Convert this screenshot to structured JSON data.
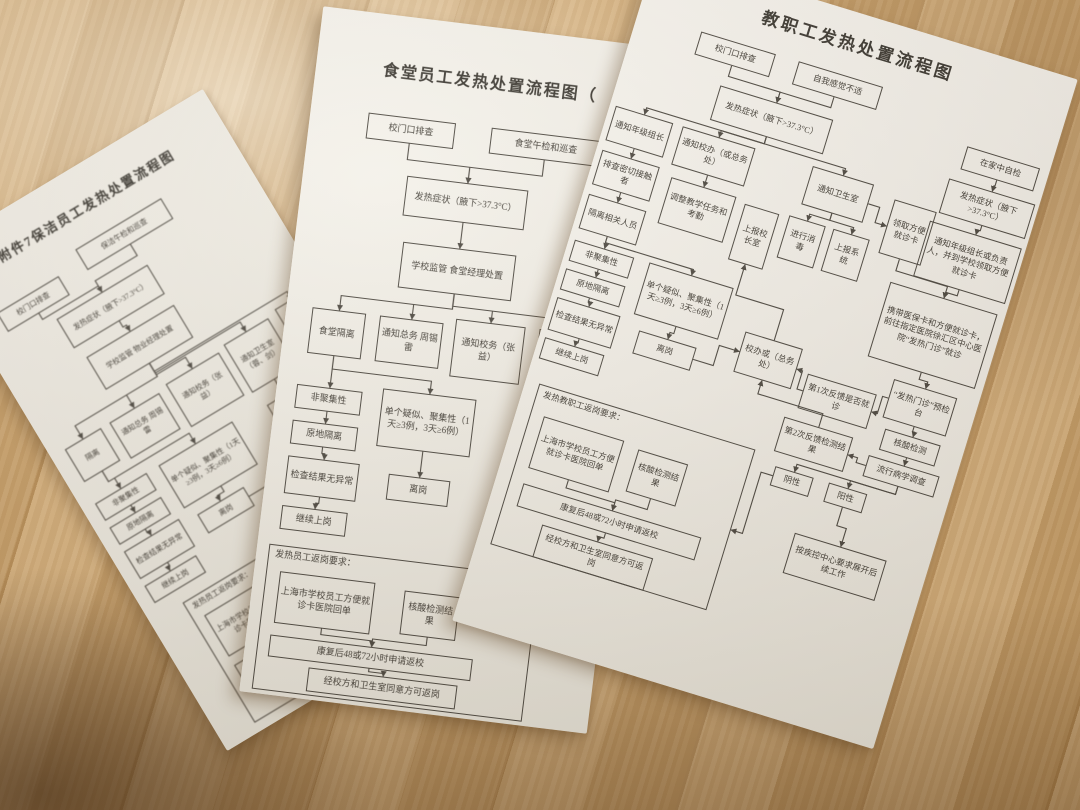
{
  "colors": {
    "wood_light": "#d7b07a",
    "wood_dark": "#bb8f55",
    "paper": "#f6f4ee",
    "ink": "#3d3a33"
  },
  "papers": [
    {
      "id": "cleaning-staff",
      "title": "附件7保洁员工发热处置流程图",
      "nodes": {
        "gate": "校门口排查",
        "patrol": "保洁午检和巡查",
        "fever": "发热症状（腋下>37.3°C）",
        "manage": "学校监管 物业经理处置",
        "isolate": "隔离",
        "notify_general": "通知总务 周锡雷",
        "notify_school": "通知校务（张益）",
        "notify_health": "通知卫生室（蓉、剑）",
        "notify_other": "通知…",
        "report_system": "上报系统",
        "non_cluster": "非聚集性",
        "isolate_in_place": "原地隔离",
        "check_normal": "检查结果无异常",
        "continue_work": "继续上岗",
        "suspect_cluster": "单个疑似、聚集性（1天≥3例，3天≥6例）",
        "leave_post": "离岗",
        "property_manage": "物业经理监管",
        "return_group": "发热员工返岗要求：",
        "card_receipt": "上海市学校员工方便就诊卡医院回单",
        "test_result": "核酸检测结果",
        "recover": "康复后48或72小时申请返校",
        "approve": "经校方和卫生室同意方可返岗"
      }
    },
    {
      "id": "canteen-staff",
      "title": "食堂员工发热处置流程图（",
      "nodes": {
        "gate": "校门口排查",
        "lunch_patrol": "食堂午检和巡查",
        "fever": "发热症状（腋下>37.3°C）",
        "manage": "学校监管 食堂经理处置",
        "canteen_isolate": "食堂隔离",
        "notify_general": "通知总务 周锡雷",
        "notify_school": "通知校务（张益）",
        "notify_health": "通知卫生室",
        "non_cluster": "非聚集性",
        "isolate_in_place": "原地隔离",
        "check_normal": "检查结果无异常",
        "continue_work": "继续上岗",
        "suspect_cluster": "单个疑似、聚集性（1天≥3例，3天≥6例）",
        "leave_post": "离岗",
        "return_group": "发热员工返岗要求：",
        "card_receipt": "上海市学校员工方便就诊卡医院回单",
        "test_result": "核酸检测结果",
        "recover": "康复后48或72小时申请返校",
        "approve": "经校方和卫生室同意方可返岗"
      }
    },
    {
      "id": "faculty-staff",
      "title": "教职工发热处置流程图",
      "nodes": {
        "gate": "校门口排查",
        "self_check": "自我感觉不适",
        "fever_sym": "发热症状（腋下>37.3°C）",
        "notify_grade": "通知年级组长",
        "notify_office": "通知校办（或总务处）",
        "check_contacts": "排查密切接触者",
        "isolate_related": "隔离相关人员",
        "adjust_teaching": "调整教学任务和考勤",
        "report_principal": "上报校长室",
        "notify_clinic": "通知卫生室",
        "disinfect": "进行消毒",
        "report_system": "上报系统",
        "get_card": "领取方便就诊卡",
        "home_check": "在家中自检",
        "fever_sym2": "发热症状（腋下>37.3°C）",
        "notify_leader_card": "通知年级组长或负责人，并到学校领取方便就诊卡",
        "go_hospital": "携带医保卡和方便就诊卡，前往指定医院徐汇区中心医院“发热门诊”就诊",
        "non_cluster": "非聚集性",
        "isolate_in_place": "原地隔离",
        "check_normal": "检查结果无异常",
        "continue_work": "继续上岗",
        "suspect_cluster": "单个疑似、聚集性（1天≥3例，3天≥6例）",
        "leave_post": "离岗",
        "school_office": "校办或（总务处）",
        "feedback1": "第1次反馈是否就诊",
        "fever_clinic": "“发热门诊”预检台",
        "nucleic_test": "核酸检测",
        "epi_survey": "流行病学调查",
        "feedback2": "第2次反馈检测结果",
        "negative": "阴性",
        "positive": "阳性",
        "follow_cdc": "按疾控中心要求展开后续工作",
        "return_group": "发热教职工返岗要求：",
        "card_receipt": "上海市学校员工方便就诊卡医院回单",
        "test_result": "核酸检测结果",
        "recover": "康复后48或72小时申请返校",
        "approve": "经校方和卫生室同意方可返岗"
      }
    }
  ]
}
